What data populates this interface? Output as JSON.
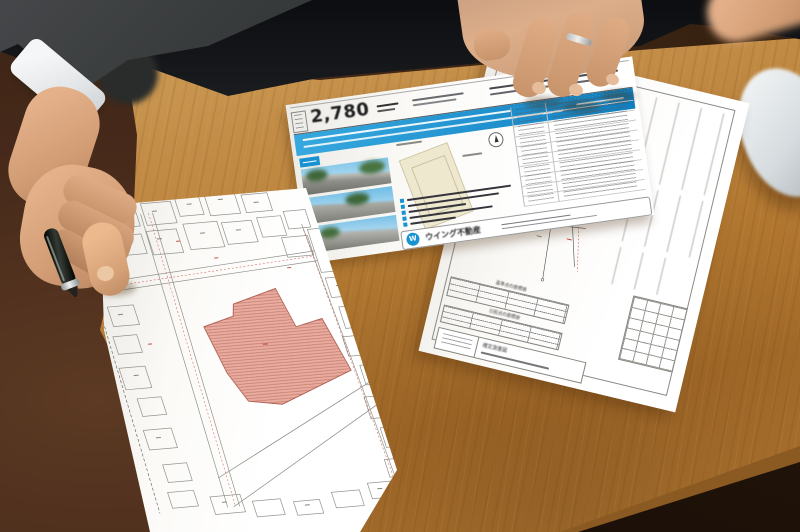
{
  "scene": {
    "description": "Close-up photograph of a real-estate meeting at a wooden table: a left hand holding a pen grips a cadastral map with a lot highlighted in red; across the table another hand rests on a property flyer and a land survey drawing; a white computer mouse sits at the right edge."
  },
  "flyer": {
    "price": "2,780",
    "company": "ウイング不動産",
    "logo_letter": "W",
    "accent_color": "#1792d2"
  },
  "survey": {
    "table1_title": "基準点の座標値",
    "table2_title": "引照点の座標値",
    "drawing_title": "確定測量図"
  },
  "map": {
    "highlight_color": "#e0a095"
  },
  "colors": {
    "table_wood": "#b97c38",
    "floor": "#3a2214"
  }
}
